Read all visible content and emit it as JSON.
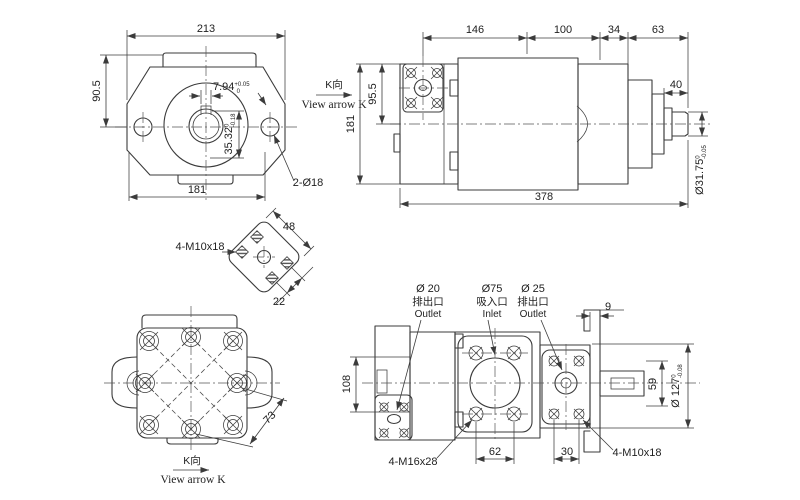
{
  "colors": {
    "line": "#3b3b3b",
    "text": "#1f1f1f",
    "background": "#ffffff"
  },
  "front_view": {
    "width_top": "213",
    "height_left": "90.5",
    "width_bottom": "181",
    "keyway_width": "7.94",
    "keyway_width_tol_up": "+0.05",
    "keyway_width_tol_dn": "0",
    "keyway_depth": "35.32",
    "keyway_depth_tol_up": "0",
    "keyway_depth_tol_dn": "-0.18",
    "mount_holes": "2-Ø18",
    "view_label_cn": "K向",
    "view_label_en": "View arrow K"
  },
  "side_view": {
    "seg1": "146",
    "seg2": "100",
    "seg3": "34",
    "seg4": "63",
    "shaft_len": "40",
    "overall_len": "378",
    "flange_height": "95.5",
    "body_height": "181",
    "shaft_dia": "Ø31.75",
    "shaft_dia_tol_up": "0",
    "shaft_dia_tol_dn": "-0.05"
  },
  "flange_detail": {
    "thread": "4-M10x18",
    "pitch_long": "48",
    "pitch_short": "22"
  },
  "rear_view": {
    "bolt_pitch": "73",
    "view_label_cn": "K向",
    "view_label_en": "View arrow K"
  },
  "top_view": {
    "outlet1": {
      "dia": "Ø 20",
      "cn": "排出口",
      "en": "Outlet"
    },
    "inlet": {
      "dia": "Ø75",
      "cn": "吸入口",
      "en": "Inlet"
    },
    "outlet2": {
      "dia": "Ø 25",
      "cn": "排出口",
      "en": "Outlet"
    },
    "plate_thickness": "9",
    "spigot_height": "59",
    "body_height": "108",
    "bolt_pitch_a": "62",
    "bolt_pitch_b": "30",
    "pilot_dia": "Ø 127",
    "pilot_dia_tol_up": "0",
    "pilot_dia_tol_dn": "-0.08",
    "thread_left": "4-M16x28",
    "thread_right": "4-M10x18"
  }
}
